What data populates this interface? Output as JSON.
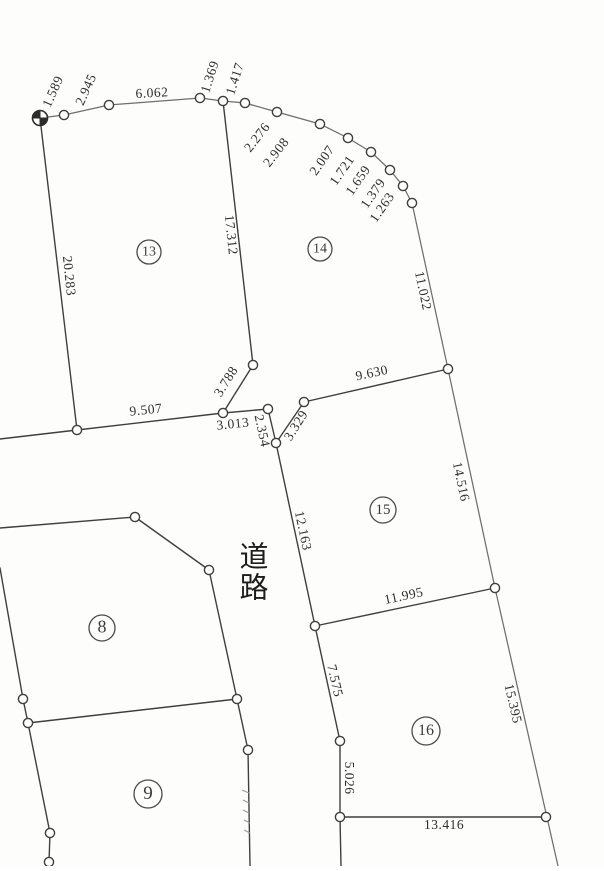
{
  "map": {
    "width": 604,
    "height": 866,
    "background": "#fdfdfc",
    "ink_dark": "#3f3f3f",
    "ink_light": "#6e6e6e",
    "marker_fill": "#ffffff",
    "road_label": {
      "text": "道路",
      "chars": [
        "道",
        "路"
      ],
      "x": 254,
      "y": 560,
      "line_height": 31,
      "font_size": 29
    },
    "benchmark": {
      "x": 40,
      "y": 118,
      "r": 7.5
    },
    "points": [
      [
        64,
        115
      ],
      [
        109,
        105
      ],
      [
        200,
        98
      ],
      [
        223,
        101
      ],
      [
        245,
        103
      ],
      [
        277,
        112
      ],
      [
        320,
        124
      ],
      [
        348,
        138
      ],
      [
        371,
        152
      ],
      [
        390,
        170
      ],
      [
        403,
        186
      ],
      [
        412,
        203
      ],
      [
        448,
        369
      ],
      [
        253,
        365
      ],
      [
        223,
        413
      ],
      [
        268,
        409
      ],
      [
        276,
        443
      ],
      [
        304,
        402
      ],
      [
        495,
        588
      ],
      [
        315,
        626
      ],
      [
        340,
        741
      ],
      [
        340,
        817
      ],
      [
        546,
        817
      ],
      [
        77,
        430
      ],
      [
        135,
        517
      ],
      [
        209,
        570
      ],
      [
        237,
        699
      ],
      [
        248,
        750
      ],
      [
        23,
        699
      ],
      [
        28,
        723
      ],
      [
        50,
        833
      ],
      [
        49,
        862
      ]
    ],
    "segments": [
      {
        "p": [
          40,
          118,
          64,
          115
        ],
        "light": true
      },
      {
        "p": [
          64,
          115,
          109,
          105
        ],
        "light": true
      },
      {
        "p": [
          109,
          105,
          200,
          98
        ],
        "light": true
      },
      {
        "p": [
          200,
          98,
          223,
          101
        ],
        "light": true
      },
      {
        "p": [
          223,
          101,
          245,
          103
        ],
        "light": true
      },
      {
        "p": [
          245,
          103,
          277,
          112
        ],
        "light": true
      },
      {
        "p": [
          277,
          112,
          320,
          124
        ],
        "light": true
      },
      {
        "p": [
          320,
          124,
          348,
          138
        ],
        "light": true
      },
      {
        "p": [
          348,
          138,
          371,
          152
        ],
        "light": true
      },
      {
        "p": [
          371,
          152,
          390,
          170
        ],
        "light": true
      },
      {
        "p": [
          390,
          170,
          403,
          186
        ],
        "light": true
      },
      {
        "p": [
          403,
          186,
          412,
          203
        ],
        "light": true
      },
      {
        "p": [
          412,
          203,
          448,
          369
        ],
        "light": true
      },
      {
        "p": [
          448,
          369,
          495,
          588
        ],
        "light": true
      },
      {
        "p": [
          495,
          588,
          558,
          866
        ],
        "light": true
      },
      {
        "p": [
          40,
          118,
          77,
          430
        ],
        "light": false
      },
      {
        "p": [
          77,
          430,
          0,
          439
        ],
        "light": false
      },
      {
        "p": [
          77,
          430,
          223,
          413
        ],
        "light": false
      },
      {
        "p": [
          223,
          413,
          268,
          409
        ],
        "light": false
      },
      {
        "p": [
          223,
          101,
          253,
          365
        ],
        "light": false
      },
      {
        "p": [
          253,
          365,
          223,
          413
        ],
        "light": false
      },
      {
        "p": [
          268,
          409,
          276,
          443
        ],
        "light": false
      },
      {
        "p": [
          276,
          443,
          304,
          402
        ],
        "light": false
      },
      {
        "p": [
          304,
          402,
          448,
          369
        ],
        "light": false
      },
      {
        "p": [
          276,
          443,
          315,
          626
        ],
        "light": false
      },
      {
        "p": [
          315,
          626,
          495,
          588
        ],
        "light": false
      },
      {
        "p": [
          315,
          626,
          340,
          741
        ],
        "light": false
      },
      {
        "p": [
          340,
          741,
          340,
          817
        ],
        "light": false
      },
      {
        "p": [
          340,
          817,
          341,
          866
        ],
        "light": false
      },
      {
        "p": [
          340,
          817,
          546,
          817
        ],
        "light": false
      },
      {
        "p": [
          0,
          528,
          135,
          517
        ],
        "light": false
      },
      {
        "p": [
          135,
          517,
          209,
          570
        ],
        "light": false
      },
      {
        "p": [
          209,
          570,
          237,
          699
        ],
        "light": false
      },
      {
        "p": [
          0,
          568,
          23,
          699
        ],
        "light": false
      },
      {
        "p": [
          23,
          699,
          28,
          723
        ],
        "light": false
      },
      {
        "p": [
          28,
          723,
          237,
          699
        ],
        "light": false
      },
      {
        "p": [
          28,
          723,
          50,
          833
        ],
        "light": false
      },
      {
        "p": [
          50,
          833,
          49,
          862
        ],
        "light": false
      },
      {
        "p": [
          49,
          862,
          49,
          866
        ],
        "light": false
      },
      {
        "p": [
          237,
          699,
          248,
          750
        ],
        "light": false
      },
      {
        "p": [
          248,
          750,
          250,
          866
        ],
        "light": false
      }
    ],
    "ticks": [
      {
        "p": [
          242,
          790,
          249,
          793
        ]
      },
      {
        "p": [
          243,
          800,
          249,
          803
        ]
      },
      {
        "p": [
          243,
          810,
          249,
          813
        ]
      },
      {
        "p": [
          244,
          820,
          250,
          823
        ]
      },
      {
        "p": [
          244,
          830,
          250,
          833
        ]
      }
    ],
    "labels": [
      {
        "t": "1.589",
        "x": 54,
        "y": 92,
        "rot": -66
      },
      {
        "t": "2.945",
        "x": 87,
        "y": 90,
        "rot": -66
      },
      {
        "t": "6.062",
        "x": 152,
        "y": 94,
        "rot": -3
      },
      {
        "t": "1.369",
        "x": 211,
        "y": 77,
        "rot": -72
      },
      {
        "t": "1.417",
        "x": 236,
        "y": 79,
        "rot": -72
      },
      {
        "t": "2.276",
        "x": 258,
        "y": 138,
        "rot": -52
      },
      {
        "t": "2.908",
        "x": 277,
        "y": 153,
        "rot": -52
      },
      {
        "t": "2.007",
        "x": 323,
        "y": 161,
        "rot": -55
      },
      {
        "t": "1.721",
        "x": 343,
        "y": 171,
        "rot": -55
      },
      {
        "t": "1.659",
        "x": 359,
        "y": 181,
        "rot": -55
      },
      {
        "t": "1.379",
        "x": 374,
        "y": 194,
        "rot": -55
      },
      {
        "t": "1.263",
        "x": 383,
        "y": 208,
        "rot": -55
      },
      {
        "t": "17.312",
        "x": 230,
        "y": 235,
        "rot": 84
      },
      {
        "t": "20.283",
        "x": 68,
        "y": 276,
        "rot": 84
      },
      {
        "t": "11.022",
        "x": 422,
        "y": 291,
        "rot": 78
      },
      {
        "t": "9.630",
        "x": 372,
        "y": 374,
        "rot": -12
      },
      {
        "t": "3.788",
        "x": 227,
        "y": 382,
        "rot": -58
      },
      {
        "t": "9.507",
        "x": 146,
        "y": 411,
        "rot": -6
      },
      {
        "t": "3.013",
        "x": 233,
        "y": 425,
        "rot": -6
      },
      {
        "t": "2.354",
        "x": 261,
        "y": 431,
        "rot": 78
      },
      {
        "t": "3.329",
        "x": 297,
        "y": 426,
        "rot": -58
      },
      {
        "t": "14.516",
        "x": 460,
        "y": 482,
        "rot": 78
      },
      {
        "t": "12.163",
        "x": 302,
        "y": 531,
        "rot": 78
      },
      {
        "t": "11.995",
        "x": 404,
        "y": 597,
        "rot": -12
      },
      {
        "t": "15.395",
        "x": 512,
        "y": 704,
        "rot": 77
      },
      {
        "t": "7.575",
        "x": 334,
        "y": 681,
        "rot": 77
      },
      {
        "t": "5.026",
        "x": 348,
        "y": 778,
        "rot": 90
      },
      {
        "t": "13.416",
        "x": 444,
        "y": 826,
        "rot": 0
      }
    ],
    "parcels": [
      {
        "n": "13",
        "x": 149,
        "y": 252,
        "r": 12,
        "fs": 14
      },
      {
        "n": "14",
        "x": 320,
        "y": 249,
        "r": 12,
        "fs": 14
      },
      {
        "n": "15",
        "x": 383,
        "y": 510,
        "r": 13,
        "fs": 15
      },
      {
        "n": "16",
        "x": 426,
        "y": 731,
        "r": 14,
        "fs": 16
      },
      {
        "n": "8",
        "x": 102,
        "y": 628,
        "r": 13,
        "fs": 18
      },
      {
        "n": "9",
        "x": 148,
        "y": 794,
        "r": 14,
        "fs": 19
      }
    ]
  }
}
